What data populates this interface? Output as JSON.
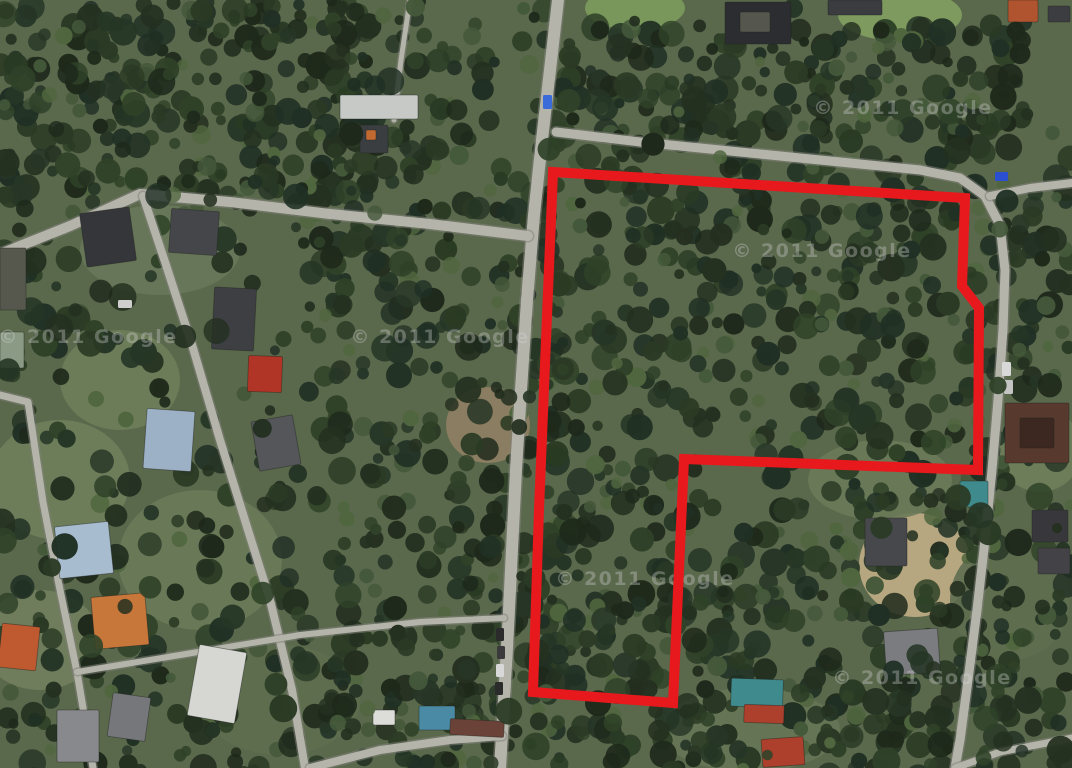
{
  "map": {
    "kind": "satellite-imagery",
    "canvas": {
      "width": 1072,
      "height": 768
    },
    "watermark": {
      "text": "© 2011 Google",
      "color": "#d6d6d6",
      "opacity": 0.34,
      "font_size": 19,
      "positions": [
        {
          "x": 88,
          "y": 343
        },
        {
          "x": 440,
          "y": 343
        },
        {
          "x": 903,
          "y": 114
        },
        {
          "x": 822,
          "y": 257
        },
        {
          "x": 645,
          "y": 585
        },
        {
          "x": 922,
          "y": 684
        }
      ]
    },
    "parcel_outline": {
      "color": "#e8191d",
      "stroke_width": 10,
      "points": [
        [
          553,
          172
        ],
        [
          965,
          198
        ],
        [
          962,
          286
        ],
        [
          979,
          308
        ],
        [
          978,
          470
        ],
        [
          684,
          459
        ],
        [
          673,
          703
        ],
        [
          533,
          692
        ],
        [
          539,
          510
        ],
        [
          546,
          340
        ]
      ]
    },
    "palette": {
      "ground": "#5a684c",
      "forest": [
        "#1e291b",
        "#243020",
        "#2a3a24",
        "#203024",
        "#2f4228",
        "#263626"
      ],
      "forest_highlight": [
        "#44583a",
        "#50663f"
      ],
      "road_fill": "#b4b4aa",
      "road_edge": "#82827a"
    },
    "clearings": {
      "format": "cx,cy,rx,ry,color",
      "items": [
        [
          635,
          8,
          50,
          22,
          "#7c9c5c"
        ],
        [
          900,
          15,
          62,
          26,
          "#82a060"
        ],
        [
          488,
          425,
          42,
          38,
          "#8f7f64"
        ],
        [
          915,
          565,
          56,
          52,
          "#c0ae86"
        ],
        [
          60,
          480,
          70,
          60,
          "#6f7f5c"
        ],
        [
          200,
          560,
          82,
          70,
          "#6a7a58"
        ],
        [
          120,
          380,
          60,
          50,
          "#6e7e5a"
        ],
        [
          40,
          640,
          60,
          50,
          "#727f5e"
        ],
        [
          280,
          700,
          80,
          55,
          "#5f6e50"
        ],
        [
          750,
          730,
          90,
          42,
          "#667555"
        ],
        [
          1010,
          600,
          60,
          60,
          "#5f6e50"
        ],
        [
          880,
          480,
          72,
          40,
          "#6a7a58"
        ],
        [
          1040,
          450,
          42,
          42,
          "#6f7f5c"
        ],
        [
          160,
          250,
          80,
          45,
          "#68785a"
        ]
      ]
    },
    "forest_regions": {
      "format": "x,y,w,h,tree_count",
      "items": [
        [
          0,
          0,
          370,
          200,
          230
        ],
        [
          330,
          0,
          230,
          768,
          300
        ],
        [
          545,
          118,
          445,
          662,
          560
        ],
        [
          555,
          25,
          470,
          112,
          150
        ],
        [
          968,
          130,
          104,
          640,
          110
        ],
        [
          0,
          185,
          345,
          590,
          200
        ],
        [
          290,
          590,
          770,
          178,
          150
        ],
        [
          0,
          0,
          1072,
          768,
          120
        ]
      ],
      "tree_radius_min": 5,
      "tree_radius_max": 14
    },
    "roads": {
      "format": "name,width,points",
      "items": [
        {
          "name": "main-road-north-south",
          "width": 12,
          "points": [
            [
              558,
              0
            ],
            [
              550,
              70
            ],
            [
              542,
              140
            ],
            [
              534,
              215
            ],
            [
              527,
              300
            ],
            [
              521,
              390
            ],
            [
              516,
              470
            ],
            [
              512,
              550
            ],
            [
              508,
              630
            ],
            [
              504,
              700
            ],
            [
              500,
              768
            ]
          ]
        },
        {
          "name": "parcel-boundary-road",
          "width": 9,
          "points": [
            [
              556,
              132
            ],
            [
              640,
              142
            ],
            [
              740,
              152
            ],
            [
              840,
              162
            ],
            [
              920,
              170
            ],
            [
              960,
              178
            ],
            [
              985,
              196
            ],
            [
              1000,
              225
            ],
            [
              1005,
              270
            ],
            [
              1003,
              330
            ],
            [
              998,
              400
            ],
            [
              992,
              470
            ],
            [
              985,
              540
            ],
            [
              977,
              610
            ],
            [
              968,
              680
            ],
            [
              960,
              740
            ],
            [
              955,
              768
            ]
          ]
        },
        {
          "name": "top-right-spur",
          "width": 8,
          "points": [
            [
              990,
              196
            ],
            [
              1030,
              188
            ],
            [
              1072,
              183
            ]
          ]
        },
        {
          "name": "left-diagonal-road",
          "width": 10,
          "points": [
            [
              0,
              254
            ],
            [
              70,
              226
            ],
            [
              140,
              194
            ],
            [
              230,
              202
            ],
            [
              330,
              214
            ],
            [
              430,
              224
            ],
            [
              528,
              236
            ]
          ]
        },
        {
          "name": "left-street",
          "width": 8,
          "points": [
            [
              143,
              196
            ],
            [
              167,
              268
            ],
            [
              193,
              348
            ],
            [
              220,
              440
            ],
            [
              248,
              530
            ],
            [
              270,
              600
            ],
            [
              292,
              690
            ],
            [
              305,
              768
            ]
          ]
        },
        {
          "name": "bottom-left-road",
          "width": 7,
          "points": [
            [
              0,
              395
            ],
            [
              28,
              402
            ],
            [
              43,
              502
            ],
            [
              58,
              580
            ],
            [
              77,
              672
            ],
            [
              93,
              768
            ]
          ]
        },
        {
          "name": "bottom-left-branch",
          "width": 6,
          "points": [
            [
              77,
              672
            ],
            [
              180,
              655
            ],
            [
              300,
              635
            ],
            [
              420,
              622
            ],
            [
              504,
              618
            ]
          ]
        },
        {
          "name": "north-footpath",
          "width": 5,
          "points": [
            [
              410,
              0
            ],
            [
              401,
              60
            ],
            [
              394,
              120
            ]
          ]
        },
        {
          "name": "bottom-edge-road",
          "width": 8,
          "points": [
            [
              310,
              768
            ],
            [
              380,
              750
            ],
            [
              450,
              740
            ],
            [
              502,
              736
            ]
          ]
        },
        {
          "name": "bottom-right-cross",
          "width": 7,
          "points": [
            [
              955,
              768
            ],
            [
              1000,
              752
            ],
            [
              1072,
              738
            ]
          ]
        }
      ]
    },
    "buildings": {
      "format": "x,y,w,h,color,rotation_deg",
      "items": [
        [
          83,
          210,
          50,
          54,
          "#35363a",
          -8
        ],
        [
          170,
          210,
          48,
          44,
          "#45464a",
          4
        ],
        [
          213,
          288,
          42,
          62,
          "#3d3f43",
          3
        ],
        [
          248,
          356,
          34,
          36,
          "#b03527",
          2
        ],
        [
          145,
          410,
          48,
          60,
          "#9db1c6",
          4
        ],
        [
          255,
          418,
          42,
          50,
          "#54565a",
          -10
        ],
        [
          0,
          248,
          26,
          62,
          "#56584e",
          0
        ],
        [
          0,
          332,
          24,
          36,
          "#8a9a84",
          0
        ],
        [
          57,
          524,
          54,
          52,
          "#a8bcd0",
          -6
        ],
        [
          93,
          595,
          54,
          52,
          "#c8773a",
          -5
        ],
        [
          0,
          625,
          38,
          44,
          "#bf5a30",
          6
        ],
        [
          57,
          710,
          42,
          52,
          "#87898d",
          0
        ],
        [
          110,
          695,
          38,
          44,
          "#75777b",
          8
        ],
        [
          193,
          648,
          48,
          72,
          "#d6d6d2",
          10
        ],
        [
          340,
          95,
          78,
          24,
          "#c6c9c6",
          0
        ],
        [
          360,
          125,
          28,
          28,
          "#3b3e40",
          0
        ],
        [
          366,
          130,
          10,
          10,
          "#c06a32",
          0
        ],
        [
          373,
          710,
          22,
          15,
          "#dcdcd8",
          0
        ],
        [
          419,
          706,
          36,
          24,
          "#4a8aa4",
          0
        ],
        [
          450,
          720,
          54,
          16,
          "#6a4238",
          3
        ],
        [
          731,
          679,
          52,
          28,
          "#3e8a8d",
          2
        ],
        [
          744,
          705,
          40,
          18,
          "#ad3f2d",
          2
        ],
        [
          762,
          738,
          42,
          28,
          "#ad3f2d",
          -4
        ],
        [
          1005,
          403,
          64,
          60,
          "#57392e",
          0
        ],
        [
          1020,
          418,
          34,
          30,
          "#3c2820",
          0
        ],
        [
          885,
          630,
          54,
          44,
          "#7a7c80",
          -4
        ],
        [
          865,
          518,
          42,
          48,
          "#47484c",
          0
        ],
        [
          960,
          481,
          28,
          26,
          "#3e8a8d",
          0
        ],
        [
          1032,
          510,
          36,
          32,
          "#38383c",
          0
        ],
        [
          1038,
          548,
          32,
          26,
          "#434347",
          0
        ],
        [
          725,
          2,
          66,
          42,
          "#2c2d31",
          0
        ],
        [
          740,
          12,
          30,
          20,
          "#55564e",
          0
        ],
        [
          828,
          0,
          54,
          15,
          "#3a3c40",
          0
        ],
        [
          1008,
          0,
          30,
          22,
          "#b05430",
          0
        ],
        [
          1048,
          6,
          22,
          16,
          "#3b3d41",
          0
        ]
      ]
    },
    "vehicles": {
      "format": "x,y,w,h,color",
      "items": [
        [
          543,
          95,
          9,
          14,
          "#3a6bd8"
        ],
        [
          995,
          172,
          13,
          9,
          "#2a4fd0"
        ],
        [
          496,
          628,
          8,
          13,
          "#2b2b2b"
        ],
        [
          497,
          646,
          8,
          13,
          "#3a3a3c"
        ],
        [
          496,
          664,
          8,
          13,
          "#d8d8d8"
        ],
        [
          495,
          682,
          8,
          13,
          "#2b2b2b"
        ],
        [
          1002,
          362,
          9,
          14,
          "#d8d8d8"
        ],
        [
          1004,
          380,
          9,
          14,
          "#c4c4c4"
        ],
        [
          118,
          300,
          14,
          8,
          "#cfcfcf"
        ]
      ]
    }
  }
}
